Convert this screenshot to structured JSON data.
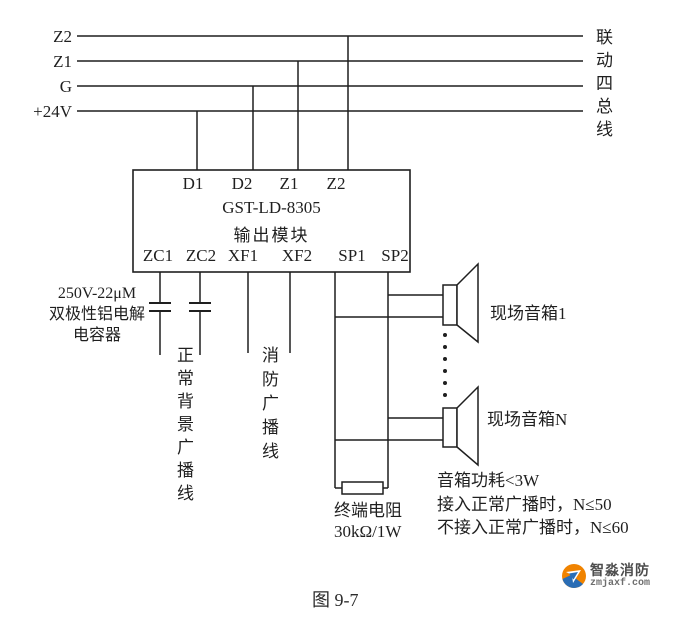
{
  "bus": {
    "labels": [
      "Z2",
      "Z1",
      "G",
      "+24V"
    ],
    "right_label": "联动四总线"
  },
  "module": {
    "top_terminals": [
      "D1",
      "D2",
      "Z1",
      "Z2"
    ],
    "name": "GST-LD-8305",
    "subtitle": "输出模块",
    "bottom_terminals": [
      "ZC1",
      "ZC2",
      "XF1",
      "XF2",
      "SP1",
      "SP2"
    ]
  },
  "capacitor_note": {
    "line1": "250V-22μM",
    "line2": "双极性铝电解",
    "line3": "电容器"
  },
  "broadcast_lines": {
    "normal": "正常背景广播线",
    "fire": "消防广播线"
  },
  "speakers": {
    "first_label": "现场音箱1",
    "last_label": "现场音箱N"
  },
  "notes": {
    "power": "音箱功耗<3W",
    "with_broadcast": "接入正常广播时，N≤50",
    "without_broadcast": "不接入正常广播时，N≤60"
  },
  "resistor": {
    "name": "终端电阻",
    "value": "30kΩ/1W"
  },
  "caption": "图 9-7",
  "logo": {
    "name": "智淼消防",
    "url": "zmjaxf.com"
  },
  "colors": {
    "line": "#1f1f1f",
    "logo_orange": "#f08300",
    "logo_blue": "#2a6db5"
  }
}
